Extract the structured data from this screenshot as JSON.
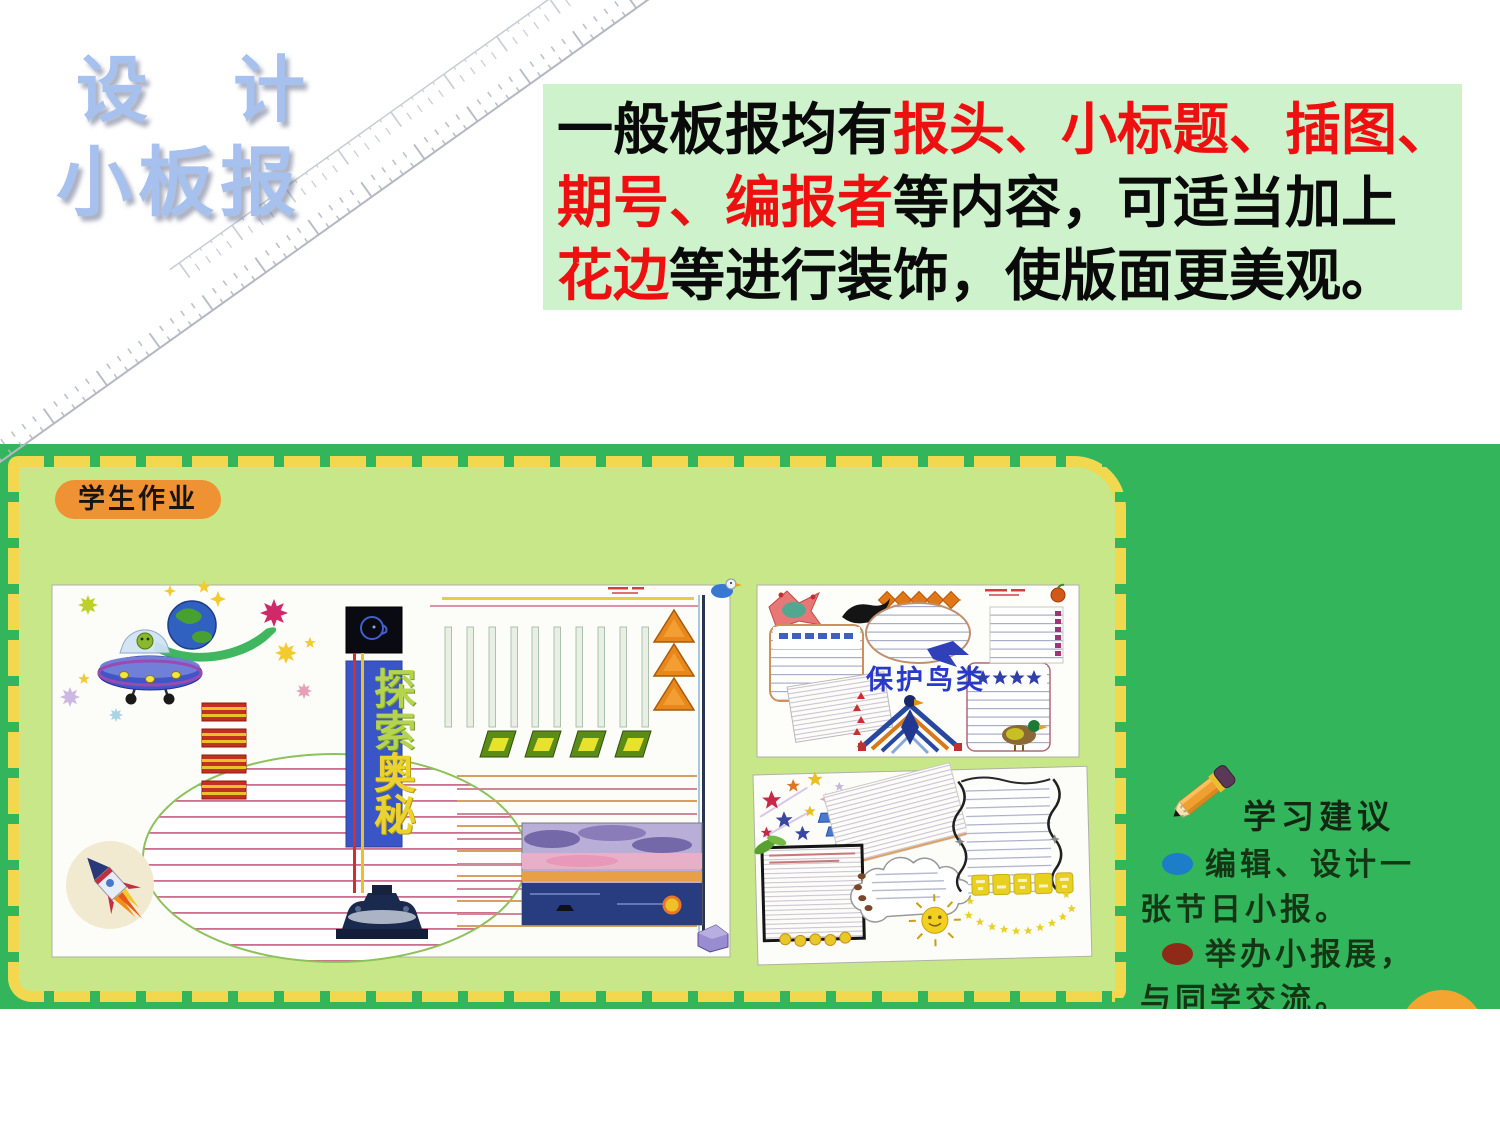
{
  "slide_title": {
    "line1": "设 计",
    "line2": "小板报"
  },
  "intro": {
    "line1_black": "一般板报均有",
    "line1_red": "报头、小标题、插图、",
    "line2_red": "期号、编报者",
    "line2_black": "等内容，可适当加上",
    "line3_red": "花边",
    "line3_black": "等进行装饰，使版面更美观。"
  },
  "workbook": {
    "label": "学生作业",
    "explore_chars": [
      "探",
      "索",
      "奥",
      "秘"
    ],
    "birds_title": "保护鸟类"
  },
  "suggestions": {
    "title": "学习建议",
    "items": [
      {
        "text": "编辑、设计一张节日小报。",
        "bullet_color": "#1c7dc8"
      },
      {
        "text": "举办小报展，与同学交流。",
        "bullet_color": "#8f2a18"
      }
    ]
  },
  "icons": {
    "pencil": "pencil-icon",
    "ruler": "ruler-decoration",
    "ufo": "ufo-spaceship",
    "earth": "earth-globe",
    "rocket": "rocket",
    "sunset": "sunset-seascape",
    "head_profile": "head-profile-icon",
    "bird_totem": "bird-totem-emblem",
    "duck": "duck",
    "sun_face": "sun-face",
    "apple": "apple-icon"
  },
  "colors": {
    "intro_bg": "#cdf2cc",
    "highlight_red": "#ee1010",
    "board_green": "#33b55b",
    "page_light_green": "#c8e789",
    "dash_yellow": "#f1d84e",
    "label_orange": "#ef9234",
    "title_blue": "#a7c1ee",
    "banner_blue": "#3a55c5",
    "explore_char_green": "#b5d44e",
    "explore_char_yellow": "#ecd22e",
    "birds_title_blue": "#2a3ac8",
    "bullet_blue": "#1c7dc8",
    "bullet_darkred": "#8f2a18",
    "orange_circle": "#f4a431"
  }
}
